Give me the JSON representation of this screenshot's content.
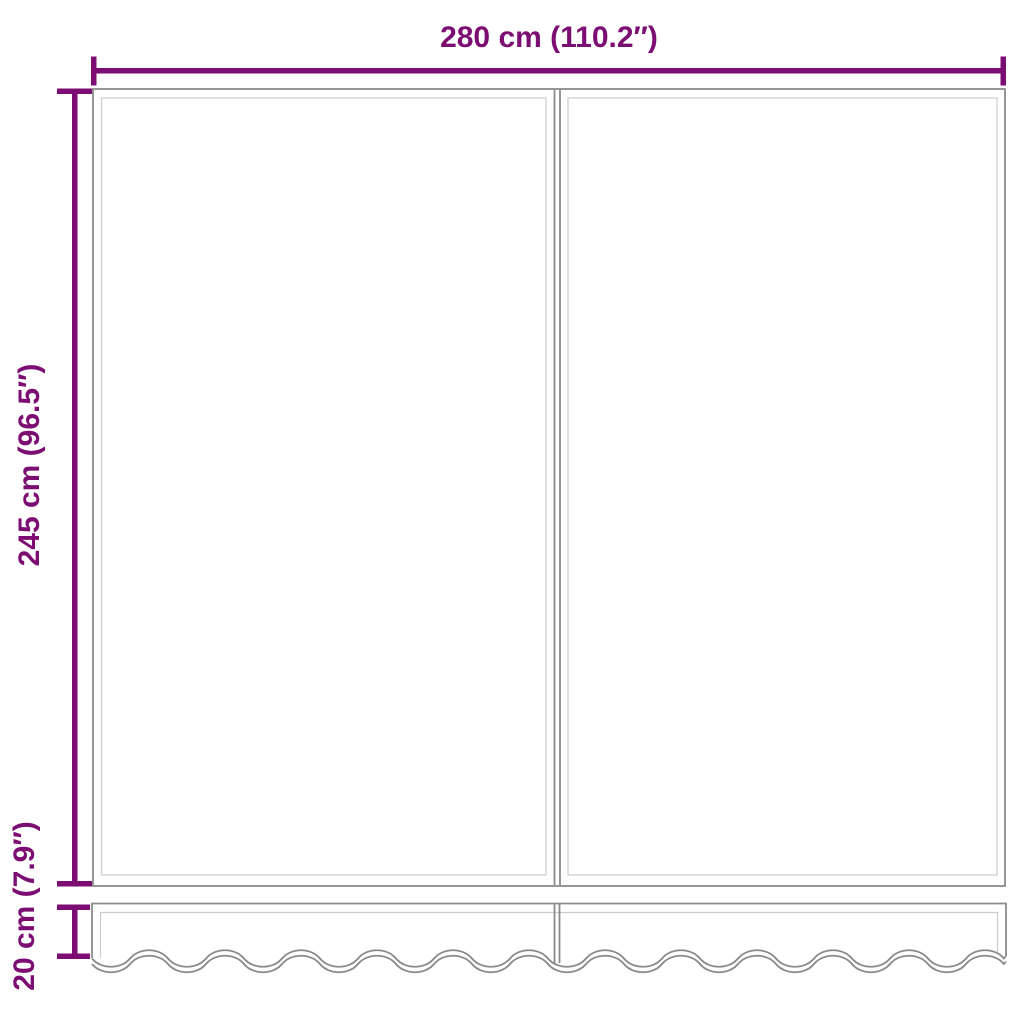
{
  "measurements": {
    "width": {
      "cm": 280,
      "inches": 110.2,
      "label": "280 cm (110.2″)"
    },
    "height": {
      "cm": 245,
      "inches": 96.5,
      "label": "245 cm (96.5″)"
    },
    "valance_height": {
      "cm": 20,
      "inches": 7.9,
      "label": "20 cm (7.9″)"
    }
  },
  "colors": {
    "dimension": "#7c0d72",
    "outline": "#8a8a8a",
    "inner_line": "#cccccc"
  }
}
